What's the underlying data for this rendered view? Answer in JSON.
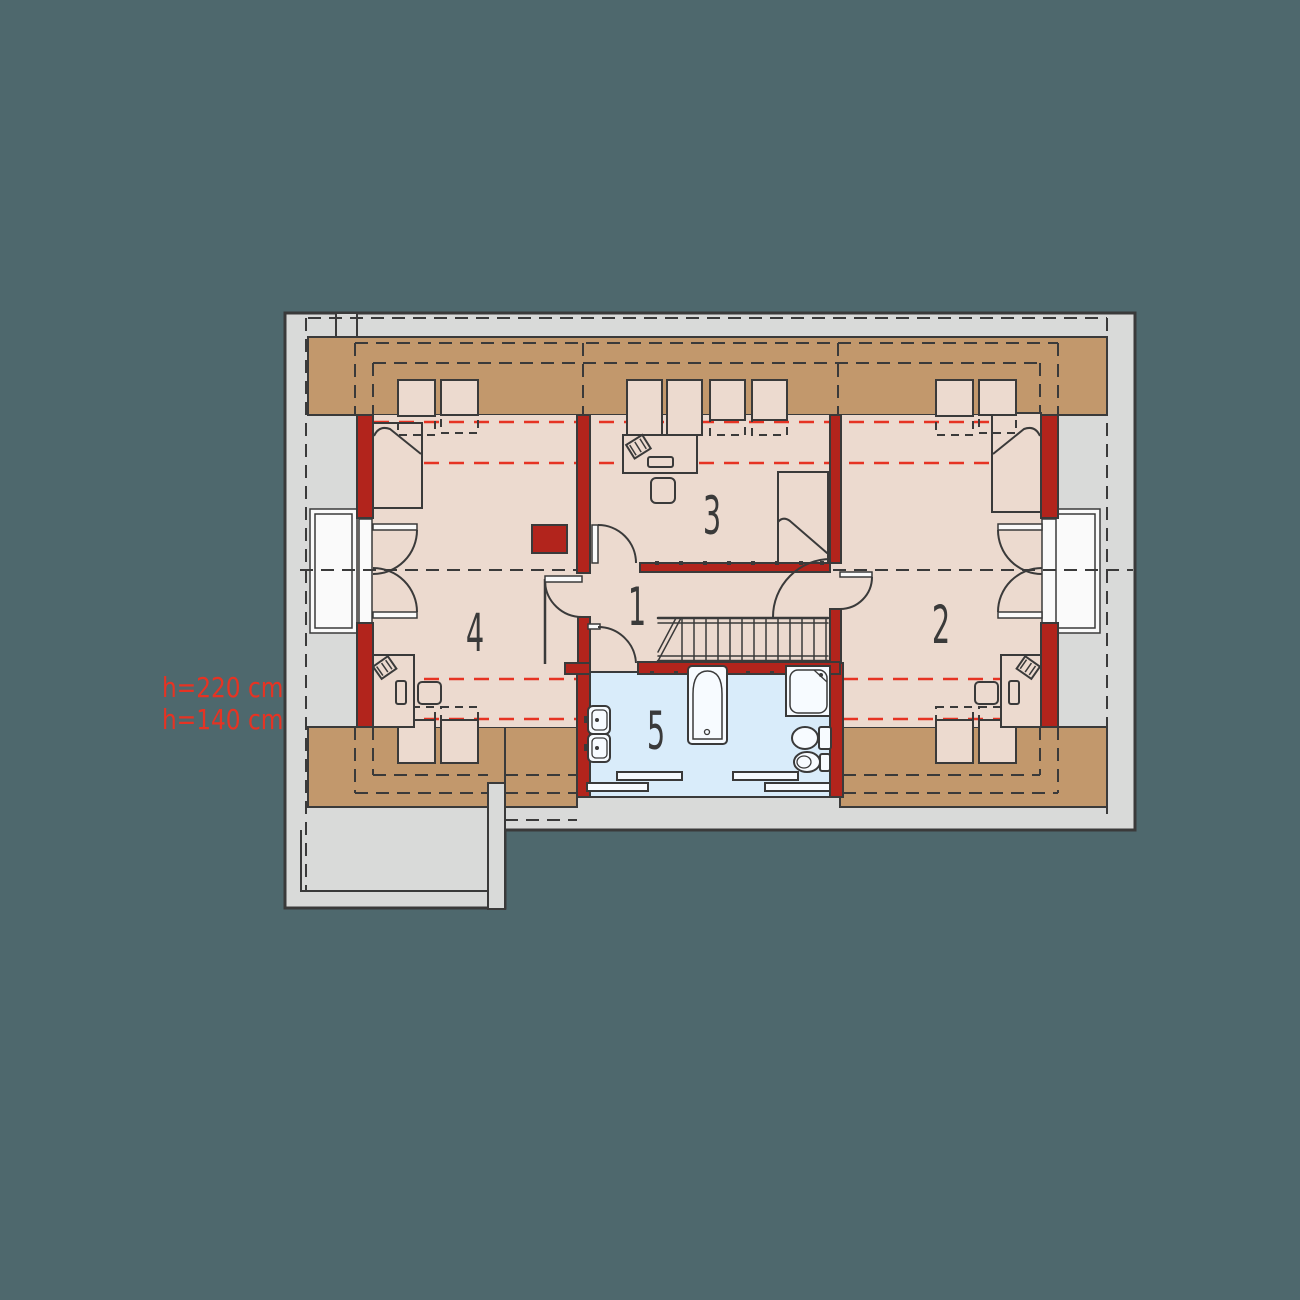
{
  "plan": {
    "type": "attic-floor-plan",
    "rooms": [
      {
        "number": "1",
        "kind": "hall-landing"
      },
      {
        "number": "2",
        "kind": "bedroom-right"
      },
      {
        "number": "3",
        "kind": "bedroom-center"
      },
      {
        "number": "4",
        "kind": "bedroom-left"
      },
      {
        "number": "5",
        "kind": "bathroom"
      }
    ],
    "annotations": {
      "height_line_1": "h=220 cm",
      "height_line_2": "h=140 cm"
    },
    "colors": {
      "background": "#4e686d",
      "exterior_gray": "#d9dad9",
      "low_eave_tan": "#c2986c",
      "room_floor": "#ecdacf",
      "bathroom_floor": "#d9ecfa",
      "masonry_wall_red": "#b2241c",
      "height_dash_red": "#e63323",
      "line_dark": "#3a3a3a",
      "window_white": "#fafafa"
    }
  }
}
